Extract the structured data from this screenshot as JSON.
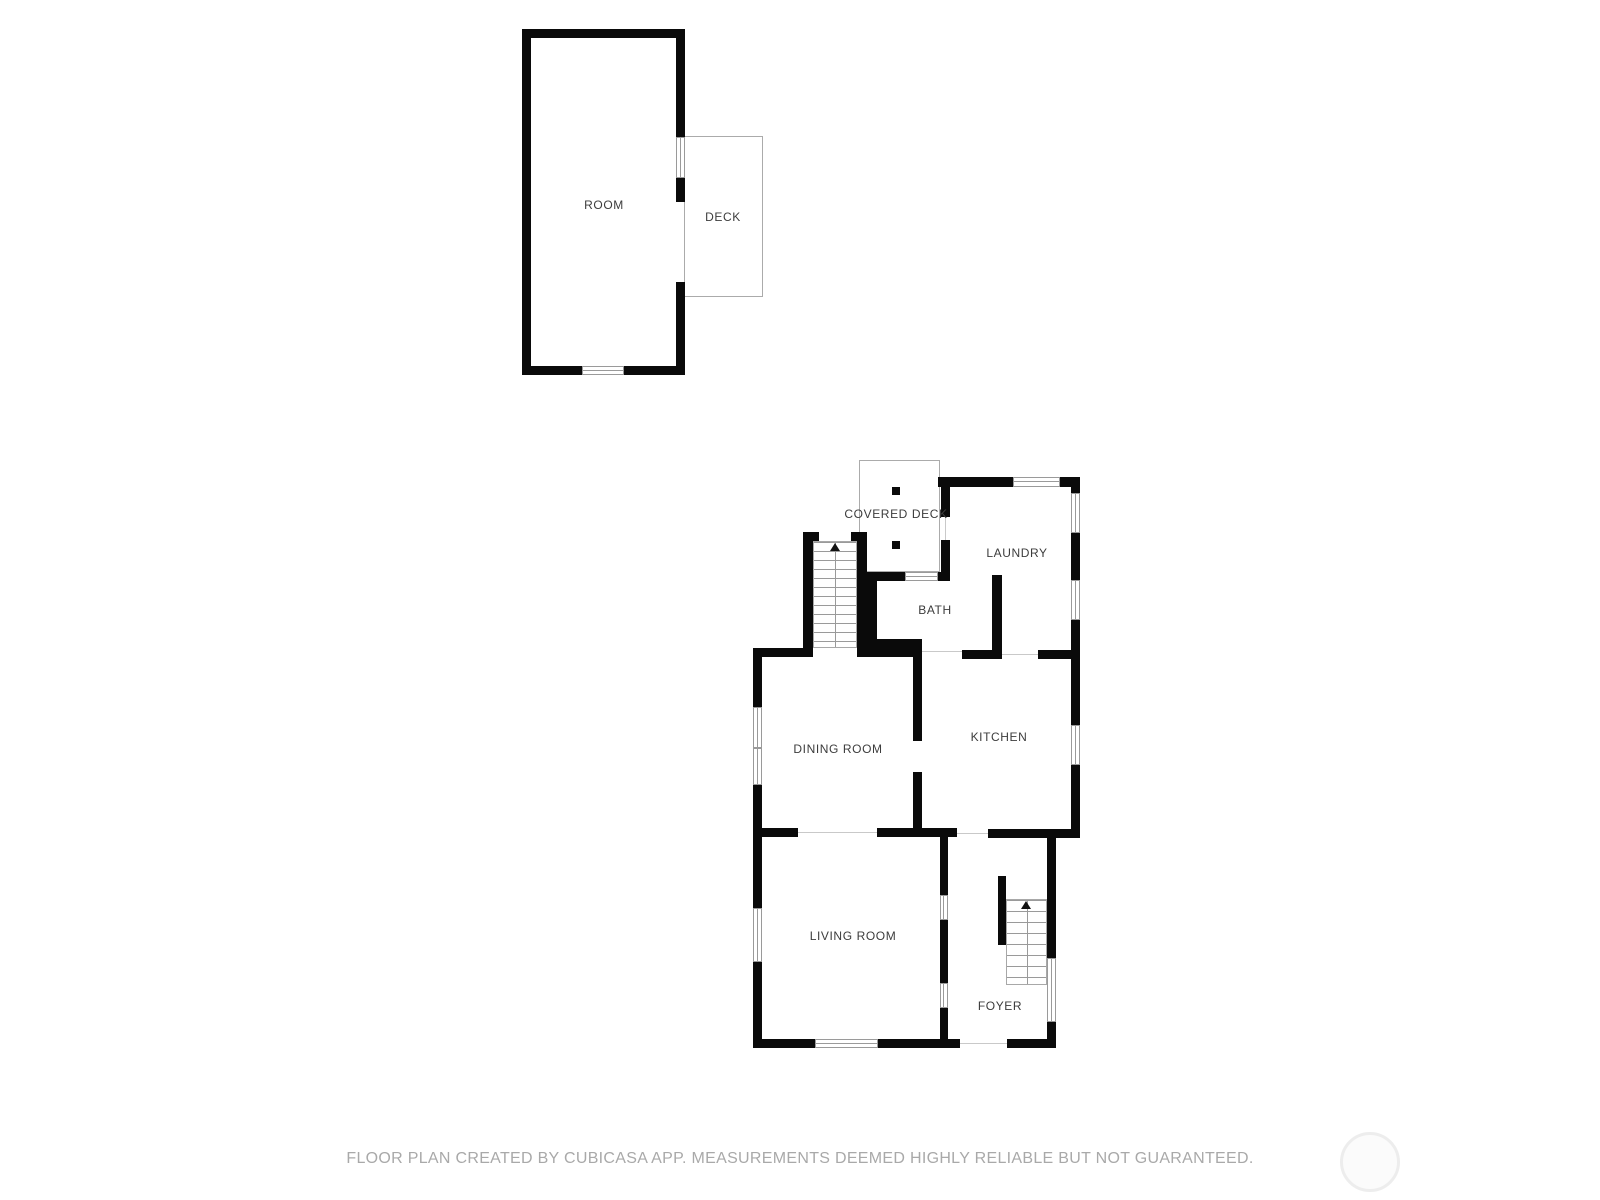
{
  "document_type": "floor-plan",
  "upper_unit": {
    "room_label": "ROOM",
    "deck_label": "DECK"
  },
  "main_unit": {
    "covered_deck_label": "COVERED DECK",
    "laundry_label": "LAUNDRY",
    "bath_label": "BATH",
    "dining_label": "DINING ROOM",
    "kitchen_label": "KITCHEN",
    "living_label": "LIVING ROOM",
    "foyer_label": "FOYER"
  },
  "icons": {
    "stairs_up_arrow": "up-triangle",
    "deck_posts": "black-square"
  },
  "footer": {
    "disclaimer": "FLOOR PLAN CREATED BY CUBICASA APP. MEASUREMENTS DEEMED HIGHLY RELIABLE BUT NOT GUARANTEED."
  },
  "colors": {
    "wall": "#0a0a0a",
    "thin_outline": "#ababab",
    "stair_line": "#9a9a9a",
    "door_line": "#c9c9c9",
    "label_text": "#3c3c3c",
    "footer_text": "#a9a9a9",
    "watermark_ring": "#ededed",
    "background": "#ffffff"
  }
}
